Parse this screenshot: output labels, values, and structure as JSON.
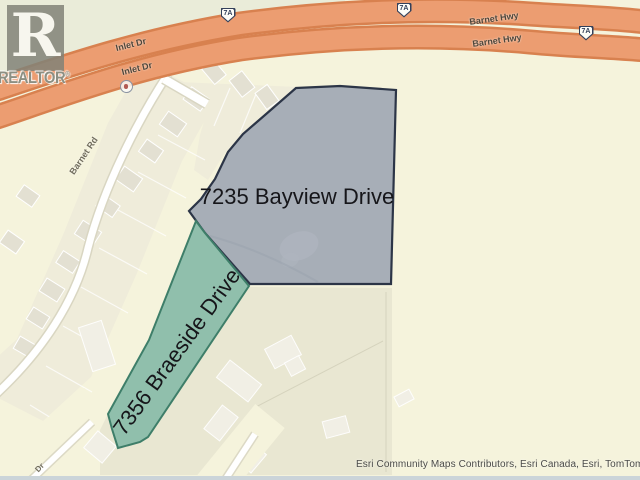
{
  "watermark": {
    "logo_letter": "R",
    "brand": "REALTOR",
    "registered": "®"
  },
  "map": {
    "colors": {
      "background": "#f5f3dc",
      "khaki_zone": "#e9e7d2",
      "beige_lots": "#efecda",
      "building": "#e3e0d2",
      "building_light": "#f1efe5",
      "highway_fill": "#ec9d71",
      "highway_casing": "#d8814f",
      "road_white": "#ffffff",
      "road_casing": "#d9d6c2",
      "parcel_bayview_fill": "#a7aeb7",
      "parcel_bayview_stroke": "#2c3547",
      "parcel_braeside_fill": "#90bfac",
      "parcel_braeside_stroke": "#3e7e69",
      "water_strip": "#cbd4d9"
    },
    "labels": [
      {
        "id": "inlet-dr-1",
        "text": "Inlet Dr",
        "x": 131,
        "y": 45,
        "rot": -14,
        "size": 9,
        "color": "#4e463a",
        "bold": true
      },
      {
        "id": "inlet-dr-2",
        "text": "Inlet Dr",
        "x": 137,
        "y": 69,
        "rot": -14,
        "size": 9,
        "color": "#4e463a",
        "bold": true
      },
      {
        "id": "barnet-hwy-1",
        "text": "Barnet Hwy",
        "x": 494,
        "y": 19,
        "rot": -8,
        "size": 9,
        "color": "#4e463a",
        "bold": true
      },
      {
        "id": "barnet-hwy-2",
        "text": "Barnet Hwy",
        "x": 497,
        "y": 41,
        "rot": -8,
        "size": 9,
        "color": "#4e463a",
        "bold": true
      },
      {
        "id": "barnet-rd",
        "text": "Barnet Rd",
        "x": 84,
        "y": 156,
        "rot": -56,
        "size": 9,
        "color": "#716d5d",
        "bold": true
      },
      {
        "id": "dr",
        "text": "Dr",
        "x": 40,
        "y": 468,
        "rot": -47,
        "size": 8,
        "color": "#716d5d",
        "bold": true
      },
      {
        "id": "bayview",
        "text": "7235 Bayview Drive",
        "x": 297,
        "y": 197,
        "rot": 0,
        "size": 22,
        "color": "#16161a",
        "bold": false,
        "prop": true
      },
      {
        "id": "braeside",
        "text": "7356 Braeside Drive",
        "x": 177,
        "y": 352,
        "rot": -54,
        "size": 22,
        "color": "#16161a",
        "bold": false,
        "prop": true
      }
    ],
    "shields": [
      {
        "text": "7A",
        "x": 228,
        "y": 15
      },
      {
        "text": "7A",
        "x": 404,
        "y": 10
      },
      {
        "text": "7A",
        "x": 586,
        "y": 33
      }
    ],
    "attribution": "Esri Community Maps Contributors, Esri Canada, Esri, TomTom, ...",
    "geometry": {
      "layers": [
        {
          "kind": "poly",
          "name": "greenish-patch-topleft",
          "points": "0,0 345,0 345,4 200,28 100,63 0,86",
          "fill": "#eaecd9"
        },
        {
          "kind": "poly",
          "name": "khaki-parcel-zone",
          "points": "197,220 250,287 392,288 392,475 100,475 100,430 108,414 149,340",
          "fill": "#e9e7d2"
        },
        {
          "kind": "path",
          "name": "khaki-parcel-lines",
          "d": "M386,292 L386,472 M383,341 L252,409 M252,409 L238,480",
          "stroke": "#d3d0ba",
          "width": 1,
          "opacity": 0.9
        },
        {
          "kind": "poly",
          "name": "beige-lot-band",
          "points": "143,61 217,99 182,161 137,273 91,377 43,421 -31,383 17,339 63,235 108,123",
          "fill": "#efecda"
        },
        {
          "kind": "poly",
          "name": "beige-lot-cluster-ne",
          "points": "178,82 298,87 263,117 240,136 224,154 208,180 194,170 200,135 208,108",
          "fill": "#efecda"
        },
        {
          "kind": "path",
          "name": "lot-lines-band",
          "d": "M158,135 L205,160 M138,172 L186,198 M118,210 L166,236 M99,248 L147,274 M81,287 L128,313 M63,326 L110,352 M46,366 L92,392 M30,405 L74,432",
          "stroke": "#ffffff",
          "width": 1.2,
          "opacity": 0.75
        },
        {
          "kind": "path",
          "name": "lot-lines-ne",
          "d": "M230,88 L214,126 M256,94 L240,133 M280,104 L262,142",
          "stroke": "#ffffff",
          "width": 1.2,
          "opacity": 0.75
        },
        {
          "kind": "houses",
          "name": "houses-beige",
          "fill": "#e3e0d2",
          "stroke": "#ffffff",
          "items": [
            [
              196,
              99,
              15,
              21,
              -55
            ],
            [
              173,
              124,
              16,
              22,
              -55
            ],
            [
              151,
              151,
              15,
              20,
              -55
            ],
            [
              129,
              179,
              16,
              22,
              -55
            ],
            [
              108,
              206,
              14,
              20,
              -55
            ],
            [
              88,
              233,
              16,
              22,
              -57
            ],
            [
              68,
              262,
              14,
              20,
              -57
            ],
            [
              52,
              290,
              15,
              21,
              -58
            ],
            [
              38,
              318,
              14,
              19,
              -58
            ],
            [
              25,
              347,
              14,
              19,
              -60
            ],
            [
              28,
              196,
              14,
              19,
              -55
            ],
            [
              12,
              242,
              15,
              20,
              -55
            ],
            [
              214,
              72,
              15,
              20,
              -40
            ],
            [
              242,
              84,
              16,
              21,
              -38
            ],
            [
              267,
              97,
              15,
              20,
              -36
            ],
            [
              287,
              111,
              13,
              18,
              -33
            ]
          ]
        },
        {
          "kind": "houses",
          "name": "houses-khaki-zone",
          "fill": "#f1efe5",
          "stroke": "rgba(255,255,255,0.9)",
          "items": [
            [
              97,
              346,
              24,
              46,
              -18
            ],
            [
              283,
              352,
              30,
              22,
              -28
            ],
            [
              295,
              366,
              16,
              15,
              -28
            ],
            [
              239,
              381,
              22,
              40,
              -52
            ],
            [
              221,
              423,
              30,
              20,
              -52
            ],
            [
              336,
              427,
              24,
              17,
              -15
            ],
            [
              404,
              398,
              17,
              11,
              -28
            ],
            [
              100,
              447,
              22,
              24,
              -50
            ],
            [
              253,
              459,
              24,
              15,
              -50
            ]
          ]
        },
        {
          "kind": "path",
          "name": "cream-corridor-bottom-left",
          "d": "M-8,486 L96,402",
          "stroke": "#f5f3dc",
          "width": 36
        },
        {
          "kind": "path",
          "name": "cream-corridor-bottom-center",
          "d": "M208,492 L270,416",
          "stroke": "#f5f3dc",
          "width": 38
        },
        {
          "kind": "path",
          "name": "road-bottom-left-casing",
          "d": "M30,481 L92,422",
          "stroke": "#dcd9c5",
          "width": 9
        },
        {
          "kind": "path",
          "name": "road-bottom-left",
          "d": "M30,481 L92,422",
          "stroke": "#ffffff",
          "width": 6
        },
        {
          "kind": "path",
          "name": "road-bottom-center-casing",
          "d": "M225,480 L255,434",
          "stroke": "#dcd9c5",
          "width": 9
        },
        {
          "kind": "path",
          "name": "road-bottom-center",
          "d": "M225,480 L255,434",
          "stroke": "#ffffff",
          "width": 6
        },
        {
          "kind": "rect",
          "name": "water-strip-bottom",
          "x": 0,
          "y": 476,
          "w": 640,
          "h": 4,
          "fill": "#cbd4d9"
        },
        {
          "kind": "poly",
          "name": "parcel-7235-bayview",
          "points": "296,88 340,86 396,90 391,284 250,284 205,233 197,222 189,211 201,199 215,179 228,152 243,134 265,115",
          "fill": "#a7aeb7",
          "stroke": "#2c3547",
          "width": 2.2
        },
        {
          "kind": "ellipse",
          "name": "bayview-building-footprint",
          "cx": 299,
          "cy": 246,
          "rx": 20,
          "ry": 14,
          "rot": -20,
          "fill": "#b0b6c0",
          "opacity": 0.65
        },
        {
          "kind": "ellipse",
          "name": "bayview-building-footprint-2",
          "cx": 290,
          "cy": 260,
          "rx": 9,
          "ry": 7,
          "rot": -20,
          "fill": "#b0b6c0",
          "opacity": 0.5
        },
        {
          "kind": "path",
          "name": "bayview-driveway",
          "d": "M210,236 Q262,250 318,282",
          "stroke": "#99a1ad",
          "width": 2,
          "opacity": 0.5
        },
        {
          "kind": "poly",
          "name": "parcel-7356-braeside",
          "points": "205,233 249,286 148,437 140,442 118,448 112,429 108,414 149,340 196,221",
          "fill": "#90bfac",
          "stroke": "#3e7e69",
          "width": 2
        },
        {
          "kind": "path",
          "name": "barnet-rd-casing",
          "d": "M168,74 C138,120 104,186 88,248 C76,300 42,352 -6,396",
          "stroke": "#d9d6c2",
          "width": 10
        },
        {
          "kind": "path",
          "name": "barnet-rd",
          "d": "M168,74 C138,120 104,186 88,248 C76,300 42,352 -6,396",
          "stroke": "#ffffff",
          "width": 7
        },
        {
          "kind": "path",
          "name": "barnet-rd-stub-casing",
          "d": "M164,79 L207,104",
          "stroke": "#d9d6c2",
          "width": 11
        },
        {
          "kind": "path",
          "name": "barnet-rd-stub",
          "d": "M164,79 L207,104",
          "stroke": "#ffffff",
          "width": 8
        },
        {
          "kind": "path",
          "name": "barnet-hwy-upper-casing",
          "d": "M-6,90 C60,68 140,40 240,24 C330,12 430,7 530,14 C575,17 615,18 646,22",
          "stroke": "#d8814f",
          "width": 25
        },
        {
          "kind": "path",
          "name": "barnet-hwy-upper",
          "d": "M-6,90 C60,68 140,40 240,24 C330,12 430,7 530,14 C575,17 615,18 646,22",
          "stroke": "#ec9d71",
          "width": 20
        },
        {
          "kind": "path",
          "name": "barnet-hwy-lower-casing",
          "d": "M-6,118 C60,96 140,65 240,49 C330,37 430,33 530,42 C572,46 614,47 646,50",
          "stroke": "#d8814f",
          "width": 25
        },
        {
          "kind": "path",
          "name": "barnet-hwy-lower",
          "d": "M-6,118 C60,96 140,65 240,49 C330,37 430,33 530,42 C572,46 614,47 646,50",
          "stroke": "#ec9d71",
          "width": 20
        }
      ]
    }
  }
}
